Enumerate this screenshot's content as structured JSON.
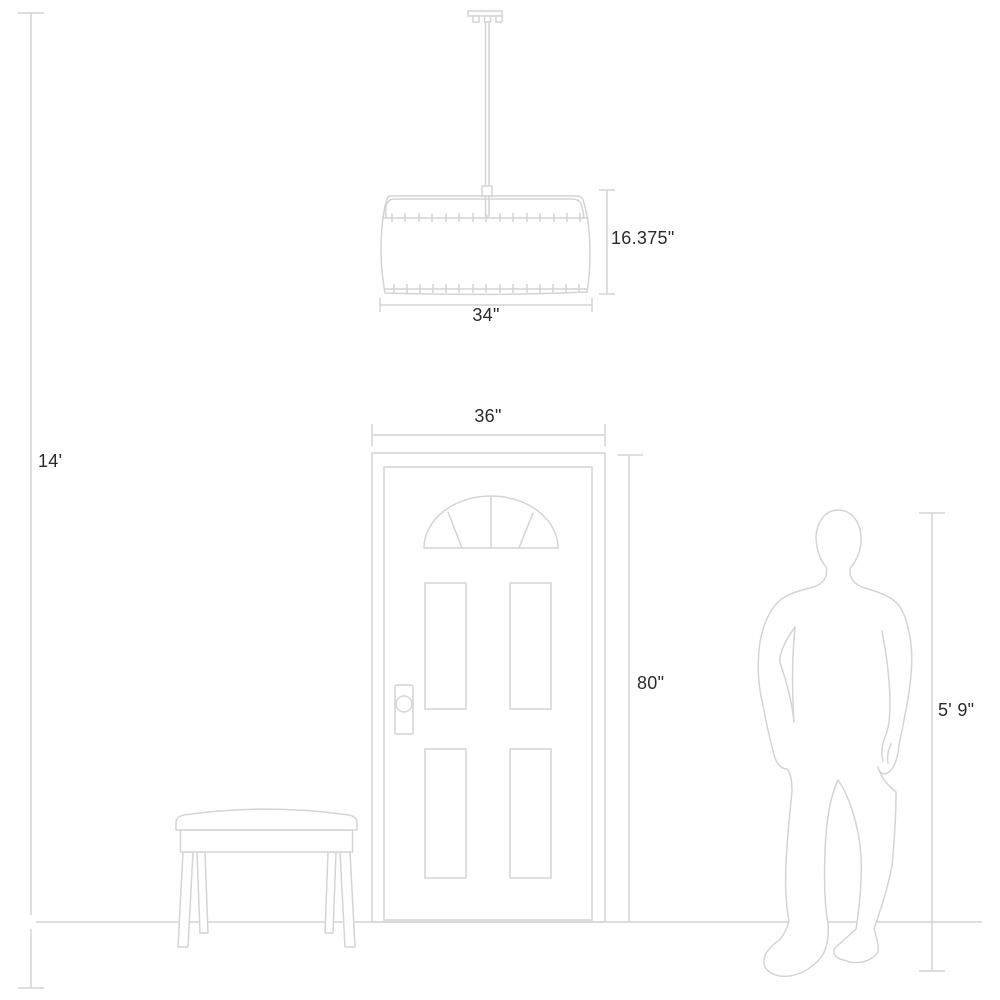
{
  "theme": {
    "background_color": "#ffffff",
    "line_color": "#d4d4d4",
    "text_color": "#2b2b2b"
  },
  "diagram": {
    "figures": {
      "pendant": "drum-pendant-light-drawing",
      "door": "four-panel-door-with-fanlight-drawing",
      "bench": "bench-drawing",
      "person": "standing-person-silhouette",
      "floor": "floor-line"
    },
    "dimensions": {
      "ceiling_height": "14'",
      "fixture_height": "16.375\"",
      "fixture_width": "34\"",
      "door_width": "36\"",
      "door_height": "80\"",
      "person_height": "5' 9\""
    }
  }
}
